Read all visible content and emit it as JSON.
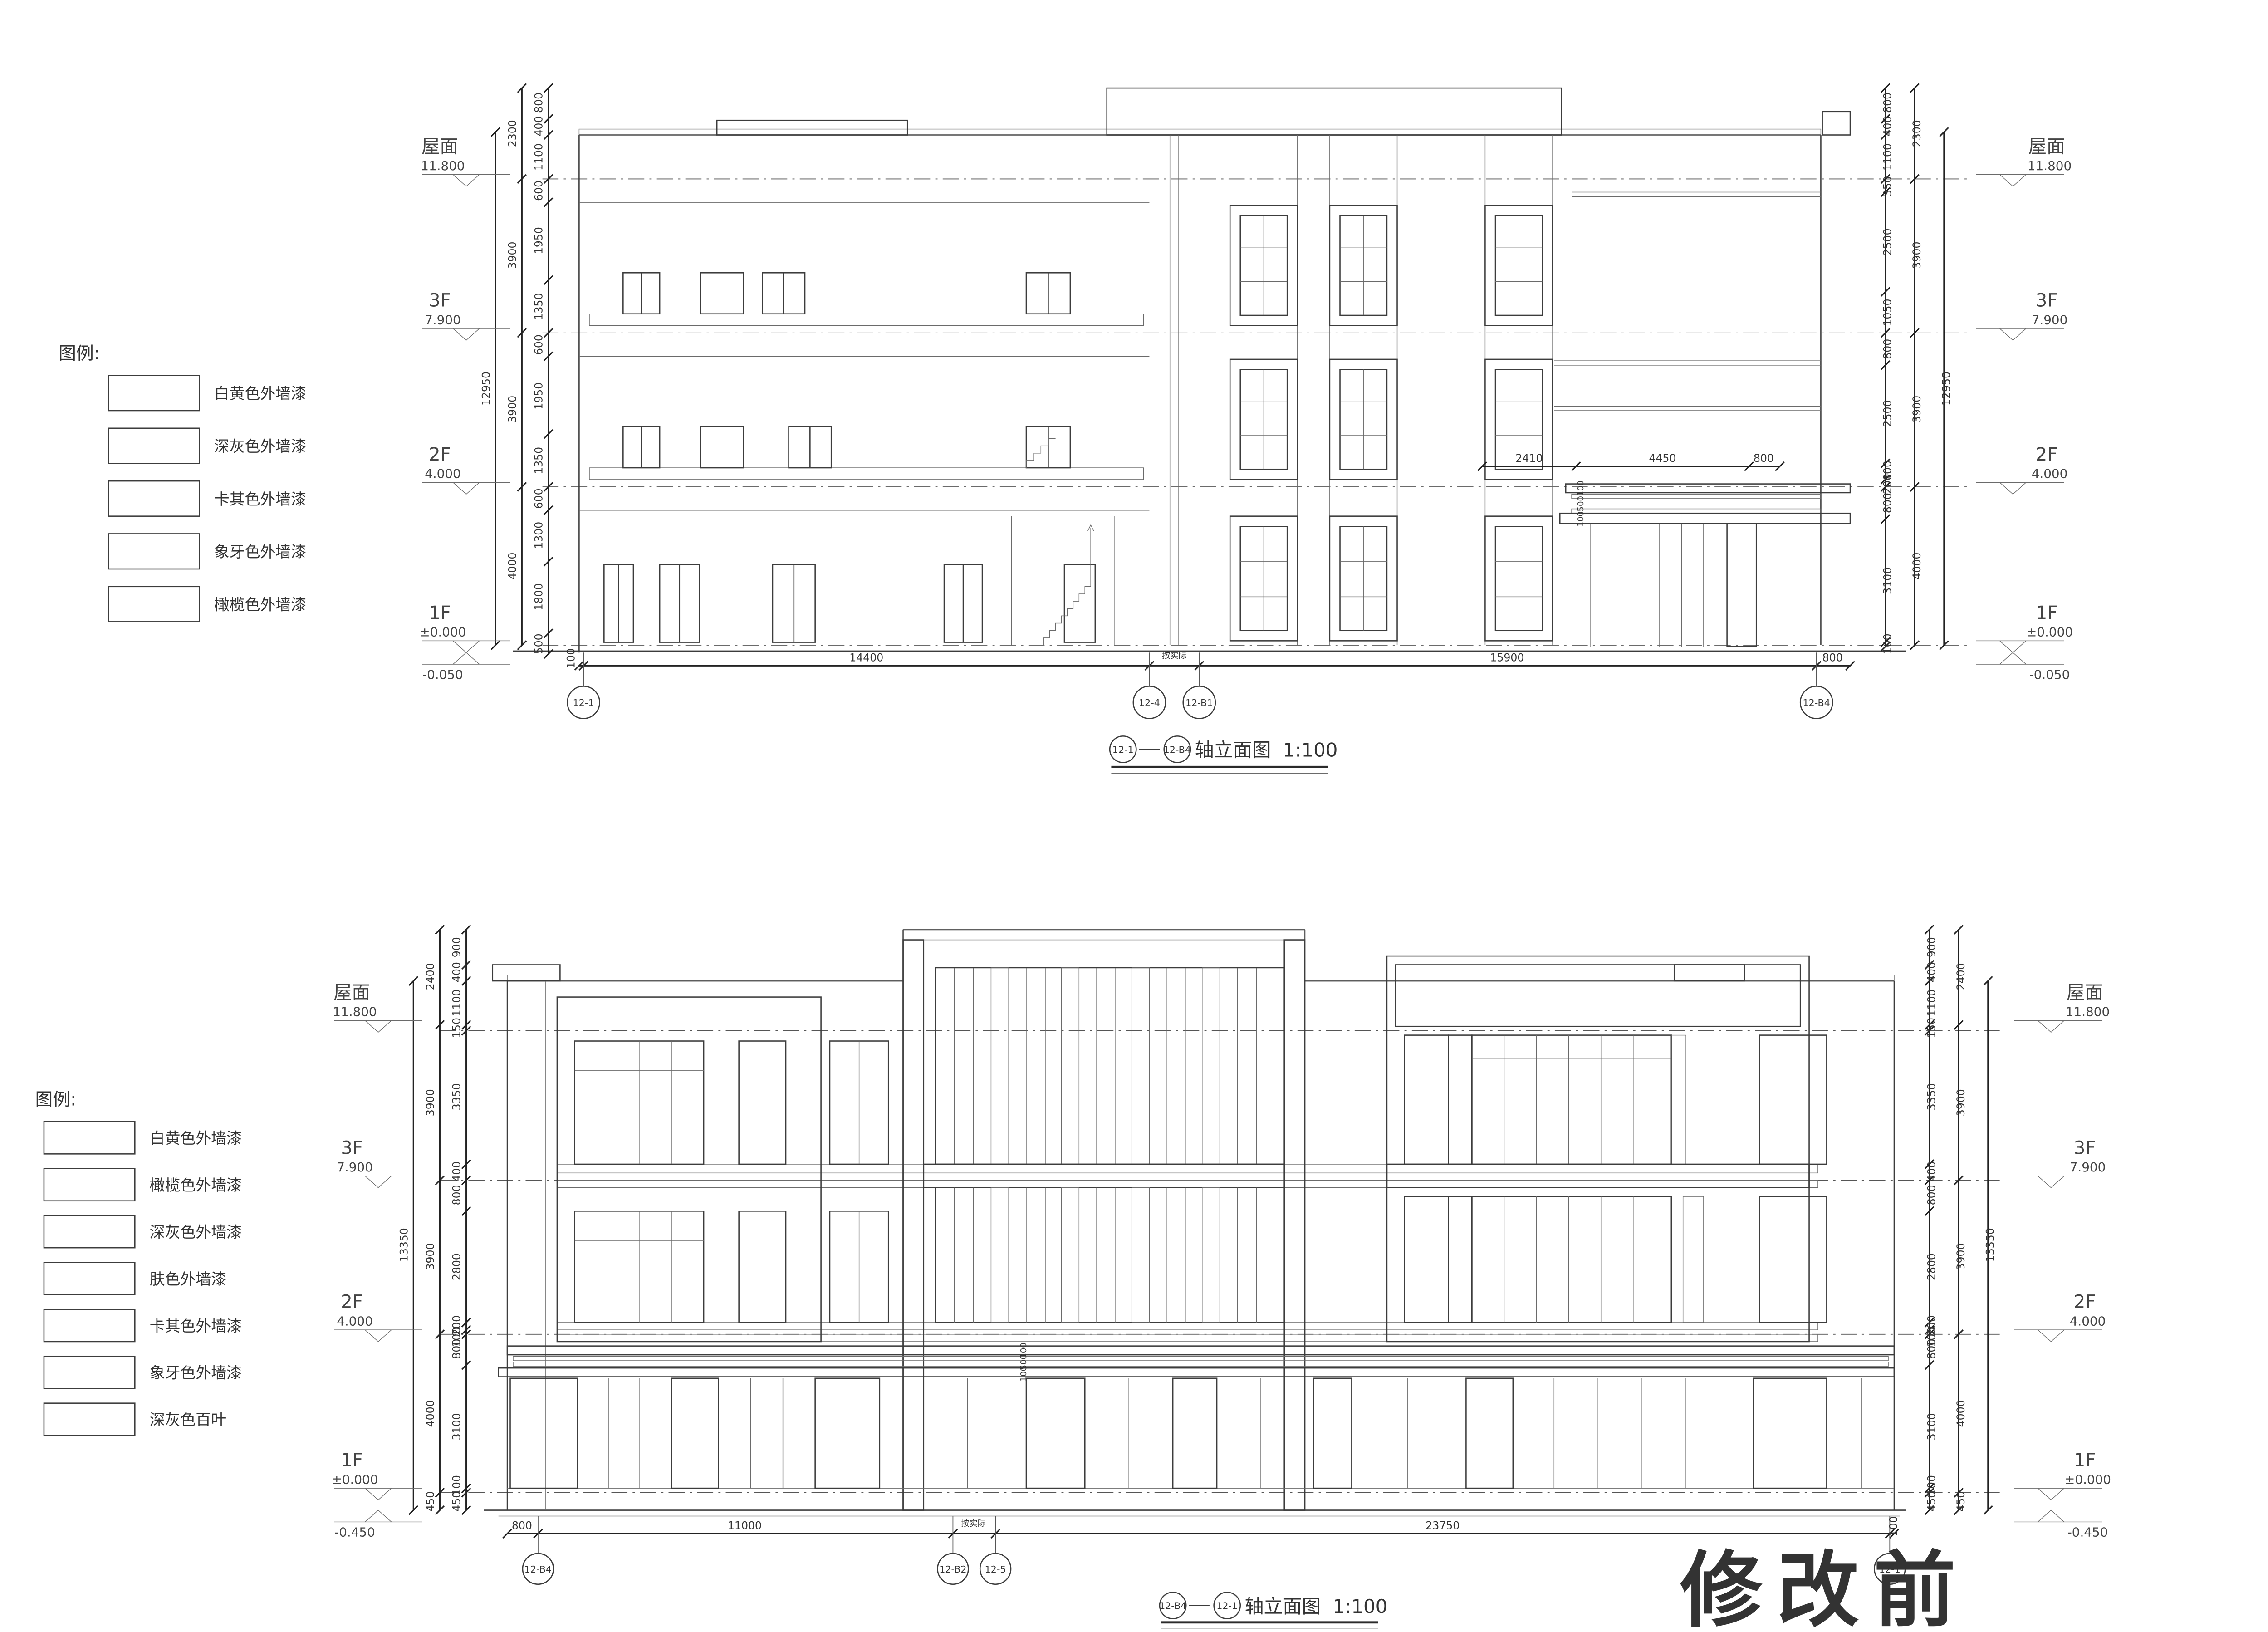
{
  "stamp": {
    "text": "修改前",
    "color": "#e60012"
  },
  "legend_top": {
    "title": "图例:",
    "items": [
      {
        "label": "白黄色外墙漆",
        "pattern": "dots"
      },
      {
        "label": "深灰色外墙漆",
        "pattern": "stipple"
      },
      {
        "label": "卡其色外墙漆",
        "pattern": "hex"
      },
      {
        "label": "象牙色外墙漆",
        "pattern": "none"
      },
      {
        "label": "橄榄色外墙漆",
        "pattern": "diag"
      }
    ]
  },
  "legend_bottom": {
    "title": "图例:",
    "items": [
      {
        "label": "白黄色外墙漆",
        "pattern": "dots"
      },
      {
        "label": "橄榄色外墙漆",
        "pattern": "diag"
      },
      {
        "label": "深灰色外墙漆",
        "pattern": "stipple"
      },
      {
        "label": "肤色外墙漆",
        "pattern": "diag-sparse"
      },
      {
        "label": "卡其色外墙漆",
        "pattern": "hex"
      },
      {
        "label": "象牙色外墙漆",
        "pattern": "none"
      },
      {
        "label": "深灰色百叶",
        "pattern": "louver"
      }
    ]
  },
  "elevation1": {
    "title": {
      "axis_start": "12-1",
      "axis_end": "12-B4",
      "text": "轴立面图",
      "scale": "1:100"
    },
    "floors": {
      "roof_label": "屋面",
      "roof_value": "11.800",
      "f3_label": "3F",
      "f3_value": "7.900",
      "f2_label": "2F",
      "f2_value": "4.000",
      "f1_label": "1F",
      "f1_value": "±0.000",
      "base_value": "-0.050"
    },
    "axes": [
      "12-1",
      "12-4",
      "12-B1",
      "12-B4"
    ],
    "dims_bottom": [
      "100",
      "14400",
      "按实际",
      "15900",
      "800"
    ],
    "dims_left_inner": [
      "800",
      "400",
      "1100",
      "600",
      "1950",
      "1350",
      "600",
      "1950",
      "1350",
      "600",
      "1300",
      "1800",
      "500"
    ],
    "dims_left_mid": [
      "2300",
      "3900",
      "3900",
      "4000"
    ],
    "dims_left_outer": "12950",
    "dims_right_inner": [
      "800",
      "400",
      "1100",
      "350",
      "2500",
      "1050",
      "800",
      "2500",
      "400",
      "200",
      "800",
      "3100",
      "100"
    ],
    "dims_right_mid": [
      "2300",
      "3900",
      "3900",
      "4000"
    ],
    "dims_right_outer": "12950",
    "dims_interior": [
      "2410",
      "4450",
      "800"
    ],
    "dims_canopy": [
      "100",
      "500",
      "100"
    ]
  },
  "elevation2": {
    "title": {
      "axis_start": "12-B4",
      "axis_end": "12-1",
      "text": "轴立面图",
      "scale": "1:100"
    },
    "floors": {
      "roof_label": "屋面",
      "roof_value": "11.800",
      "f3_label": "3F",
      "f3_value": "7.900",
      "f2_label": "2F",
      "f2_value": "4.000",
      "f1_label": "1F",
      "f1_value": "±0.000",
      "base_value": "-0.450"
    },
    "axes": [
      "12-B4",
      "12-B2",
      "12-5",
      "12-1"
    ],
    "dims_bottom": [
      "800",
      "11000",
      "按实际",
      "23750",
      "100"
    ],
    "dims_left_inner": [
      "900",
      "400",
      "1100",
      "150",
      "3350",
      "400",
      "800",
      "2800",
      "200",
      "100",
      "800",
      "3100",
      "100",
      "450"
    ],
    "dims_left_mid": [
      "2400",
      "3900",
      "3900",
      "4000",
      "450"
    ],
    "dims_left_outer": "13350",
    "dims_right_inner": [
      "900",
      "400",
      "1100",
      "150",
      "3350",
      "400",
      "800",
      "2800",
      "200",
      "100",
      "800",
      "3100",
      "100",
      "450"
    ],
    "dims_right_mid": [
      "2400",
      "3900",
      "3900",
      "4000",
      "450"
    ],
    "dims_right_outer": "13350",
    "dims_canopy": [
      "100",
      "500",
      "100"
    ]
  }
}
